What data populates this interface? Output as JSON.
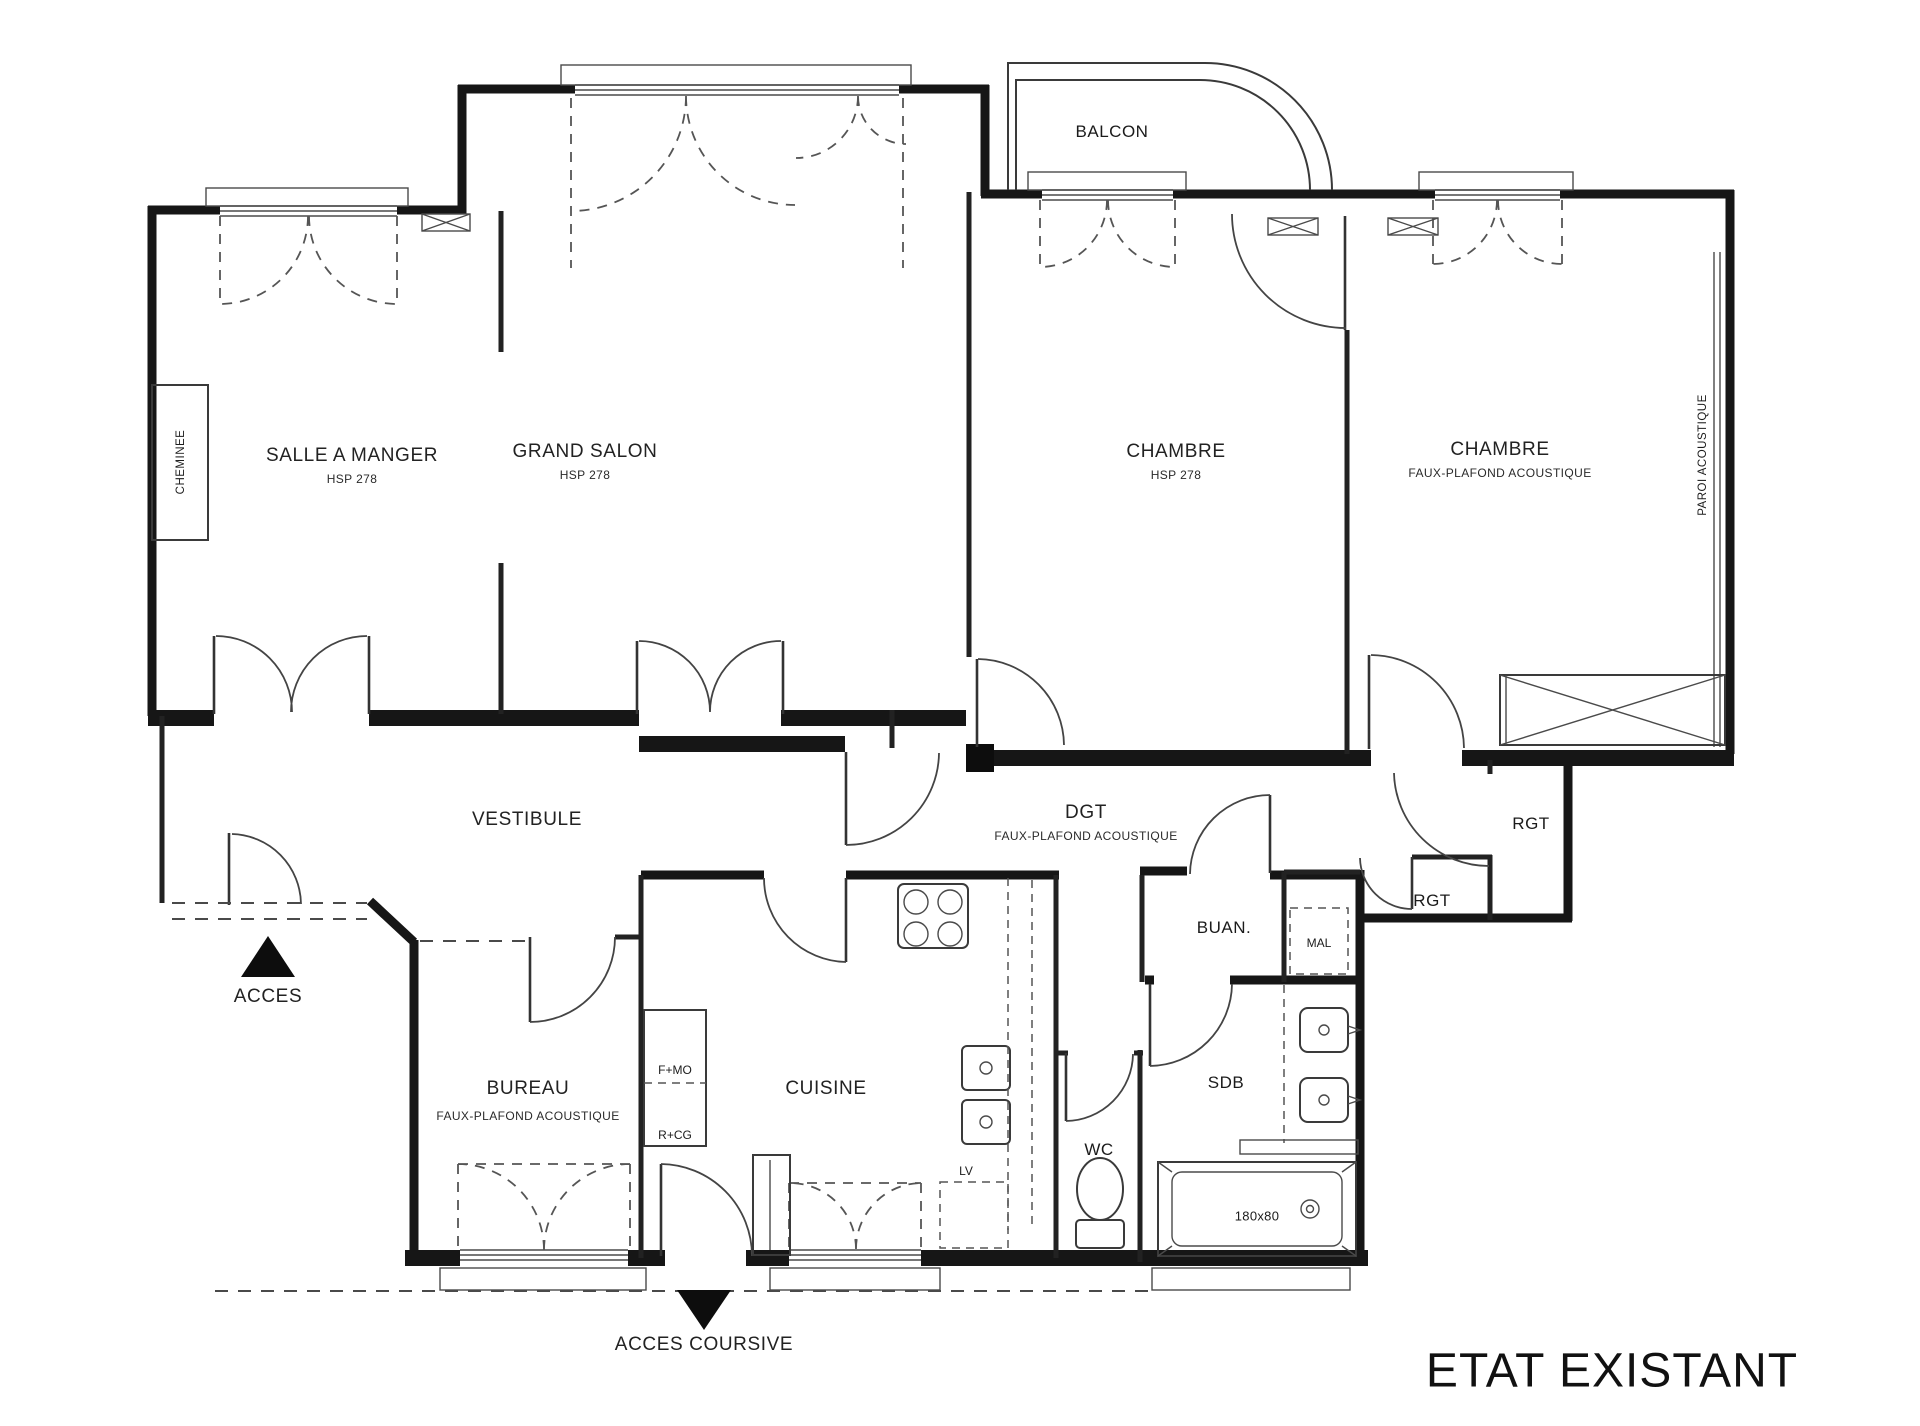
{
  "title": "ETAT EXISTANT",
  "rooms": {
    "salle_a_manger": {
      "label": "SALLE A MANGER",
      "sub": "HSP 278"
    },
    "grand_salon": {
      "label": "GRAND SALON",
      "sub": "HSP 278"
    },
    "chambre_1": {
      "label": "CHAMBRE",
      "sub": "HSP 278"
    },
    "chambre_2": {
      "label": "CHAMBRE",
      "sub": "FAUX-PLAFOND ACOUSTIQUE"
    },
    "balcon": {
      "label": "BALCON"
    },
    "vestibule": {
      "label": "VESTIBULE"
    },
    "dgt": {
      "label": "DGT",
      "sub": "FAUX-PLAFOND ACOUSTIQUE"
    },
    "rgt_upper": {
      "label": "RGT"
    },
    "rgt_lower": {
      "label": "RGT"
    },
    "buanderie": {
      "label": "BUAN."
    },
    "bureau": {
      "label": "BUREAU",
      "sub": "FAUX-PLAFOND ACOUSTIQUE"
    },
    "cuisine": {
      "label": "CUISINE"
    },
    "wc": {
      "label": "WC"
    },
    "sdb": {
      "label": "SDB"
    }
  },
  "annotations": {
    "cheminee": "CHEMINEE",
    "paroi_acoustique": "PAROI ACOUSTIQUE",
    "acces": "ACCES",
    "acces_coursive": "ACCES COURSIVE",
    "mal": "MAL",
    "lv": "LV",
    "f_mo": "F+MO",
    "r_cg": "R+CG",
    "tub_size": "180x80"
  },
  "colors": {
    "wall": "#161616",
    "line": "#444444",
    "background": "#ffffff"
  }
}
